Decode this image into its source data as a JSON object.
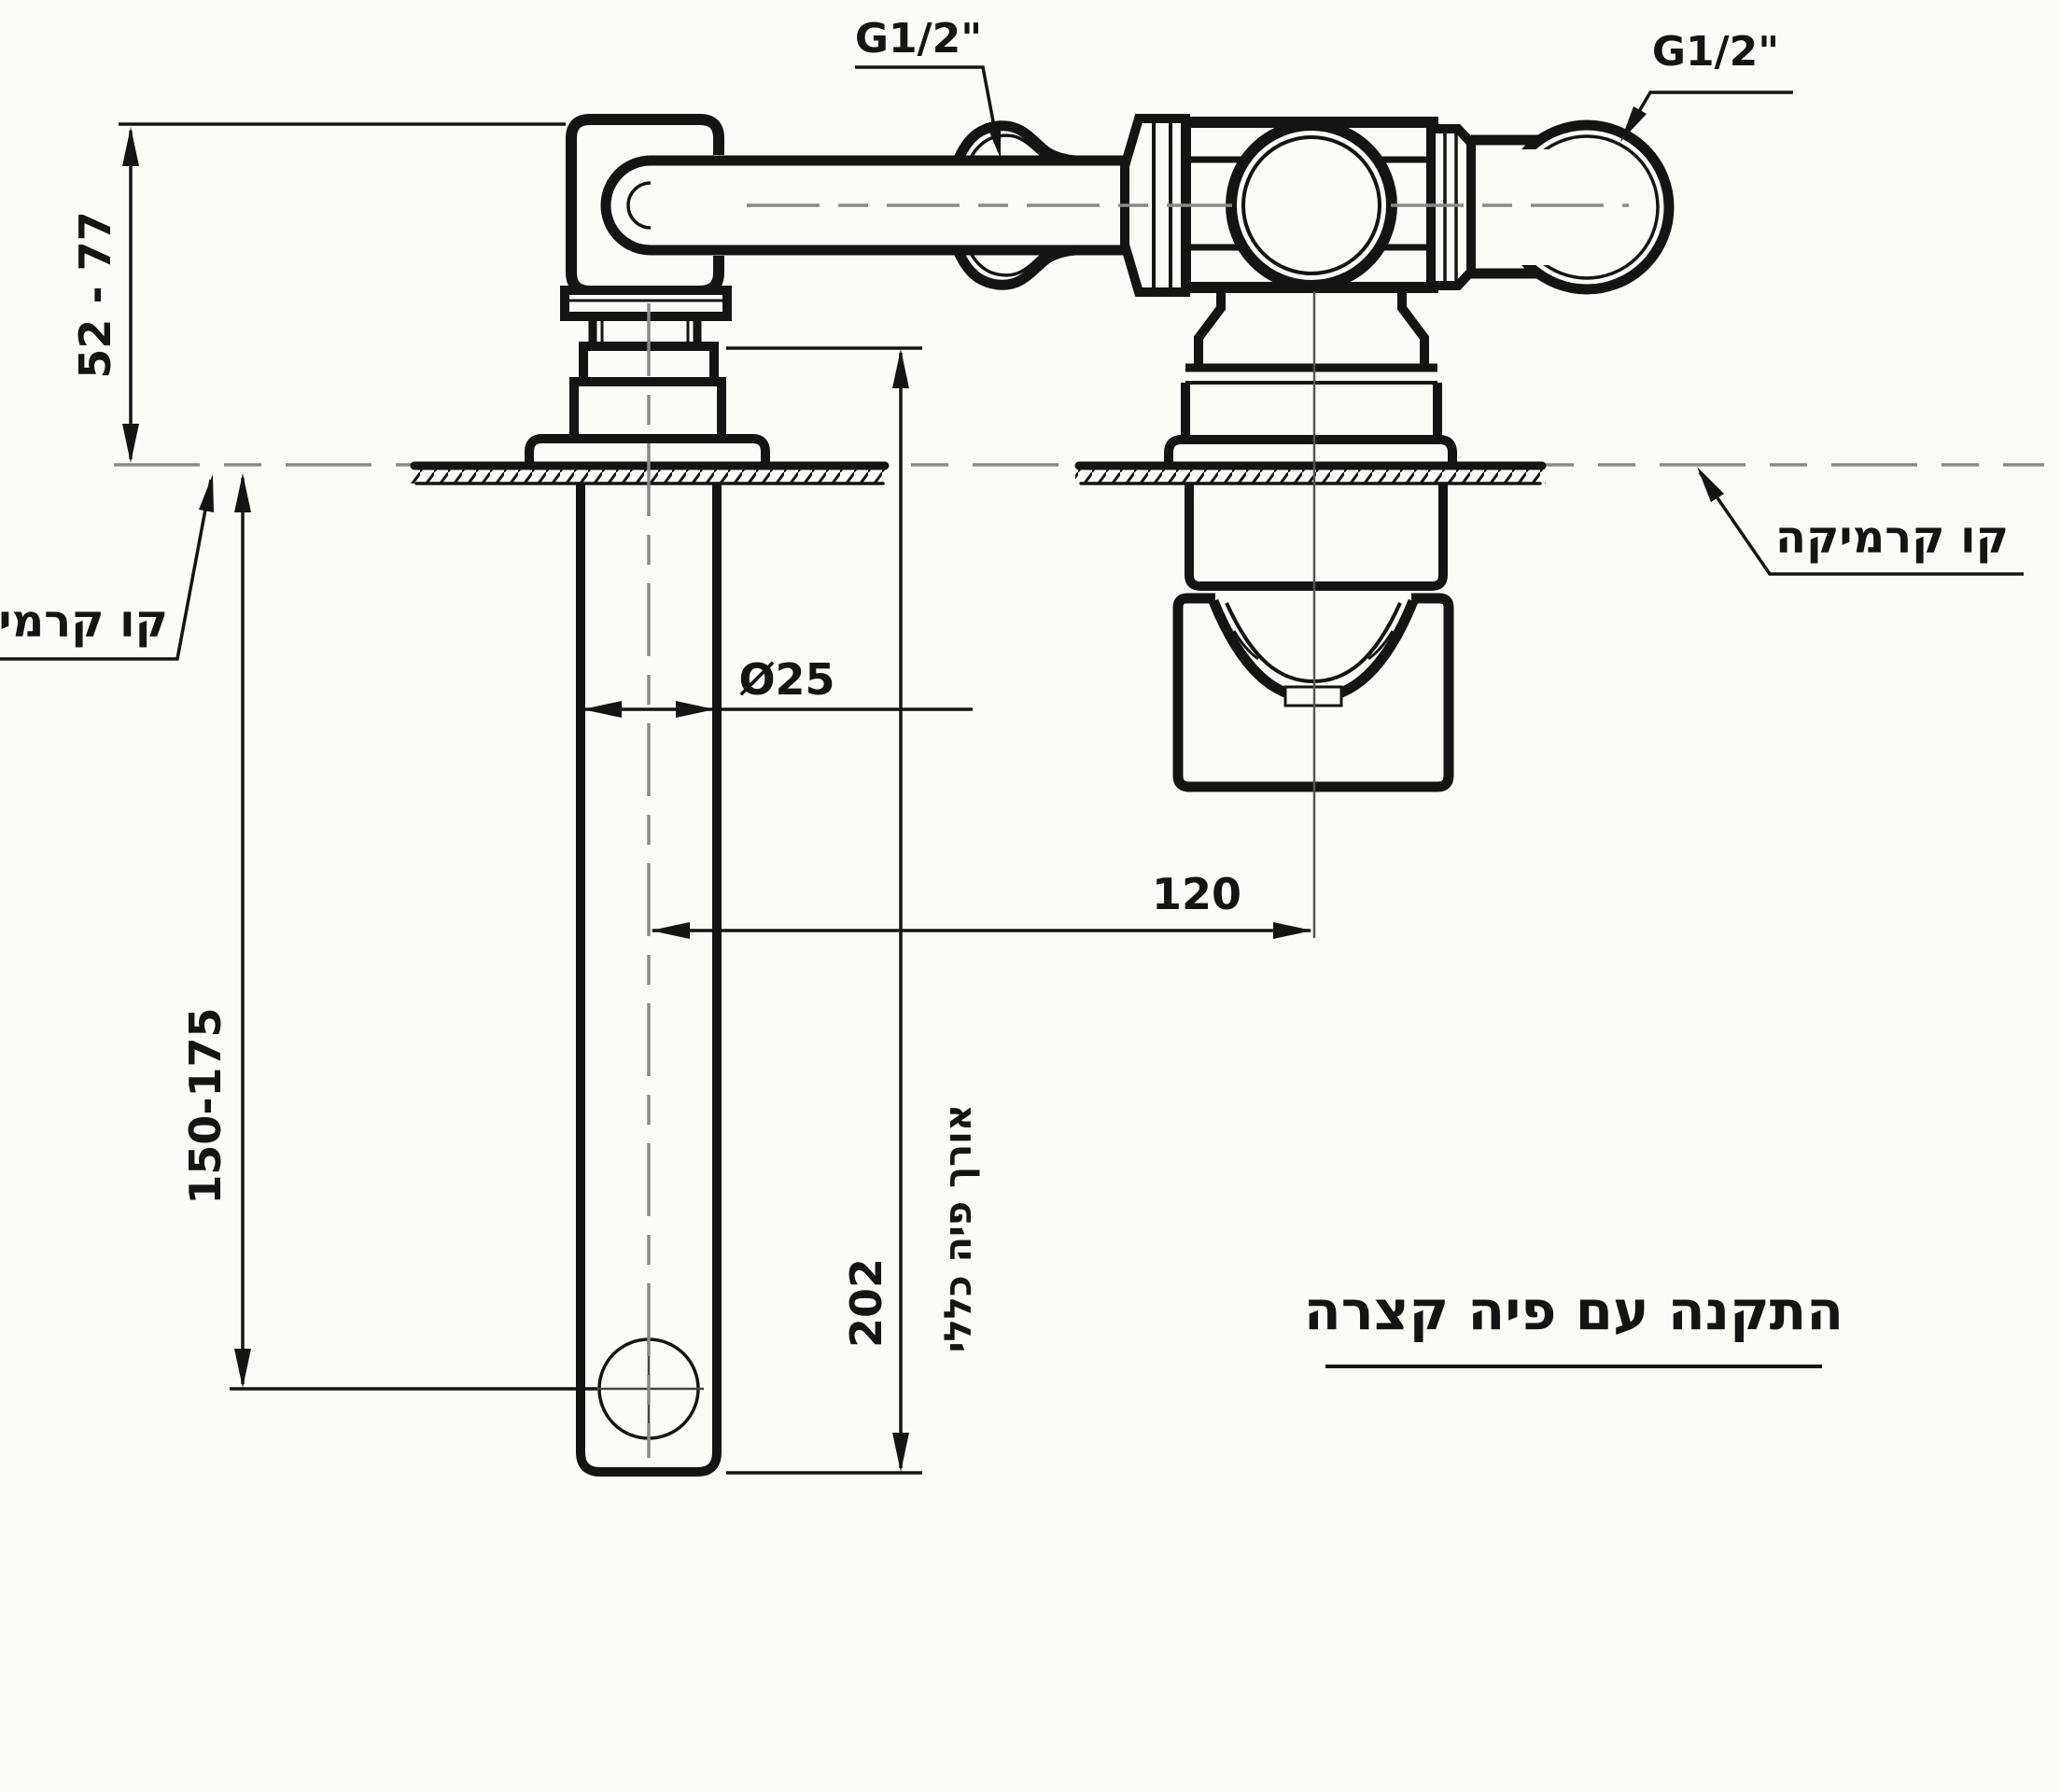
{
  "meta": {
    "type": "technical-installation-drawing",
    "subject": "wall-mounted basin faucet, side section view"
  },
  "title": {
    "text": "התקנה עם פיה קצרה"
  },
  "labels": {
    "thread_size_left": "G1/2\"",
    "thread_size_right": "G1/2\"",
    "ceramic_line_left": "קו קרמיקה",
    "ceramic_line_right": "קו קרמיקה",
    "overall_spout_length_note": "אורך פיה כללי"
  },
  "dimensions": {
    "recess_depth_range": "52 - 77",
    "spout_tube_diameter": "Ø25",
    "spout_to_valve_distance": "120",
    "below_ceramic_range": "150-175",
    "overall_spout_length": "202"
  },
  "colors": {
    "line": "#141414",
    "centerline": "#8a8a8a",
    "background": "#fbfbf8"
  }
}
